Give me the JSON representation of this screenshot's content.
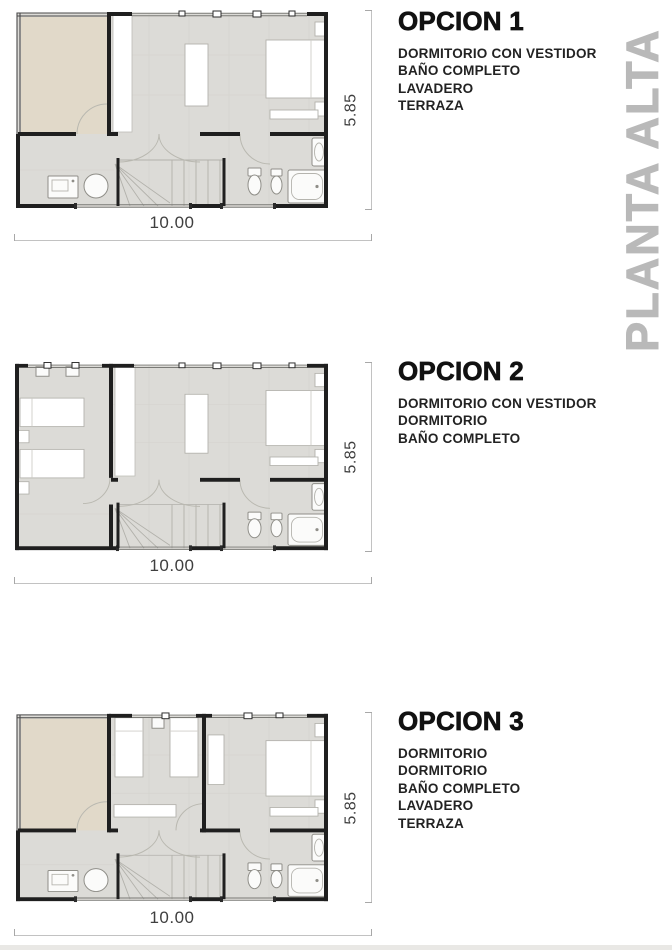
{
  "side_title": "PLANTA ALTA",
  "options": [
    {
      "title": "OPCION 1",
      "rooms": [
        "DORMITORIO CON VESTIDOR",
        "BAÑO COMPLETO",
        "LAVADERO",
        "TERRAZA"
      ],
      "width_label": "10.00",
      "height_label": "5.85"
    },
    {
      "title": "OPCION 2",
      "rooms": [
        "DORMITORIO CON VESTIDOR",
        "DORMITORIO",
        "BAÑO COMPLETO"
      ],
      "width_label": "10.00",
      "height_label": "5.85"
    },
    {
      "title": "OPCION 3",
      "rooms": [
        "DORMITORIO",
        "DORMITORIO",
        "BAÑO COMPLETO",
        "LAVADERO",
        "TERRAZA"
      ],
      "width_label": "10.00",
      "height_label": "5.85"
    }
  ],
  "colors": {
    "wall": "#1f1f1f",
    "floor": "#dcdbd7",
    "terrace": "#e1d9c9",
    "dimension_line": "#c2c2c2",
    "dimension_text": "#3f3f3f",
    "side_title": "#b9b9b9",
    "text": "#1c1c1c"
  }
}
